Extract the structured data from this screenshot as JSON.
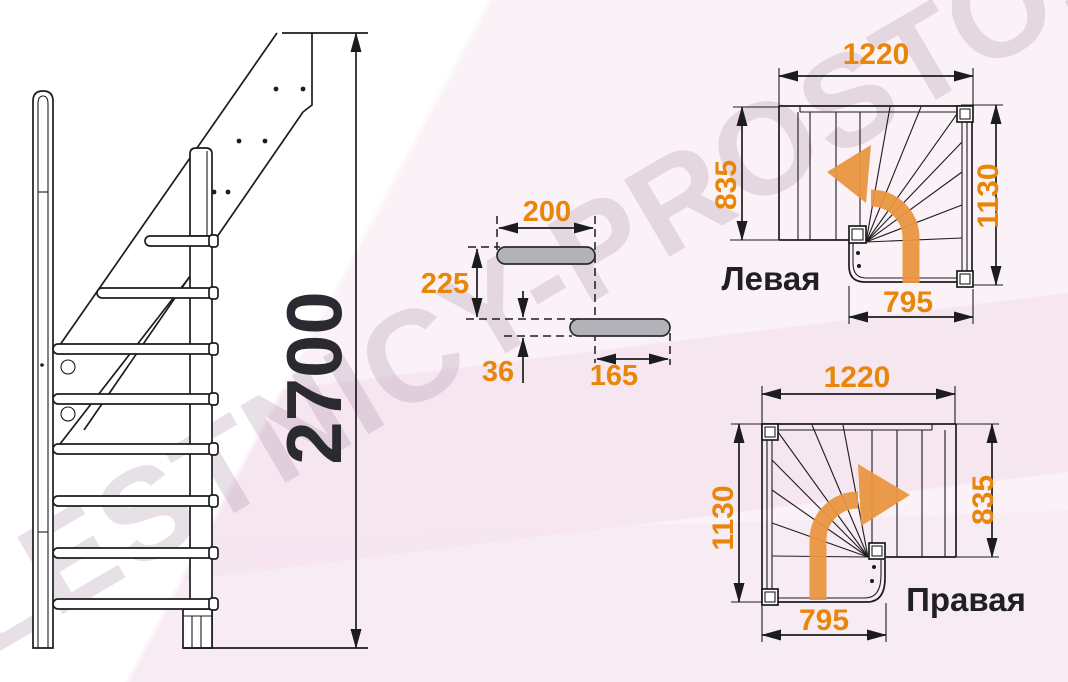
{
  "watermark": "LESTNICY-PROSTO.RU",
  "side_view": {
    "total_height": "2700"
  },
  "step_detail": {
    "tread_depth": "200",
    "step_rise": "225",
    "tread_thickness": "36",
    "tread_overlap": "165"
  },
  "plan_left": {
    "caption": "Левая",
    "top_width": "1220",
    "side_depth": "835",
    "flight_length": "1130",
    "exit_width": "795"
  },
  "plan_right": {
    "caption": "Правая",
    "top_width": "1220",
    "flight_length": "1130",
    "side_depth": "835",
    "exit_width": "795"
  },
  "colors": {
    "dimension_text": "#e8860a",
    "diagram_line": "#1c1c1f",
    "turn_arrow": "#e99640",
    "step_fill": "#b3b2b8",
    "caption_text": "#1f1f24",
    "watermark_text": "#af98af"
  }
}
